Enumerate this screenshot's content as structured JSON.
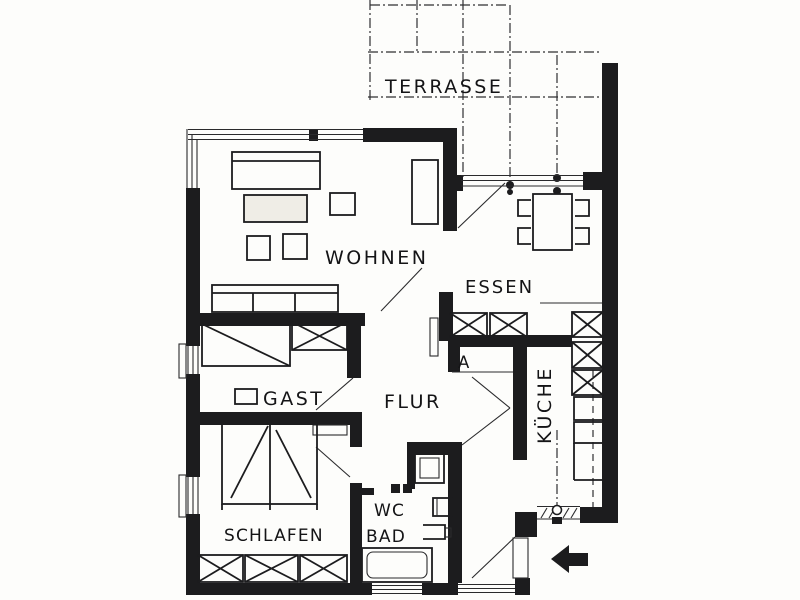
{
  "page": {
    "paper_color": "#fdfdfb",
    "ink_color": "#1c1c1e",
    "kind": "scanned apartment floor plan"
  },
  "plan": {
    "labels": {
      "terrasse": "TERRASSE",
      "wohnen": "WOHNEN",
      "essen": "ESSEN",
      "gast": "GAST",
      "flur": "FLUR",
      "abstellraum": "A",
      "kueche": "KÜCHE",
      "wc": "WC",
      "bad": "BAD",
      "schlafen": "SCHLAFEN"
    },
    "icons": {
      "entrance_arrow": "solid-left-arrow"
    }
  }
}
